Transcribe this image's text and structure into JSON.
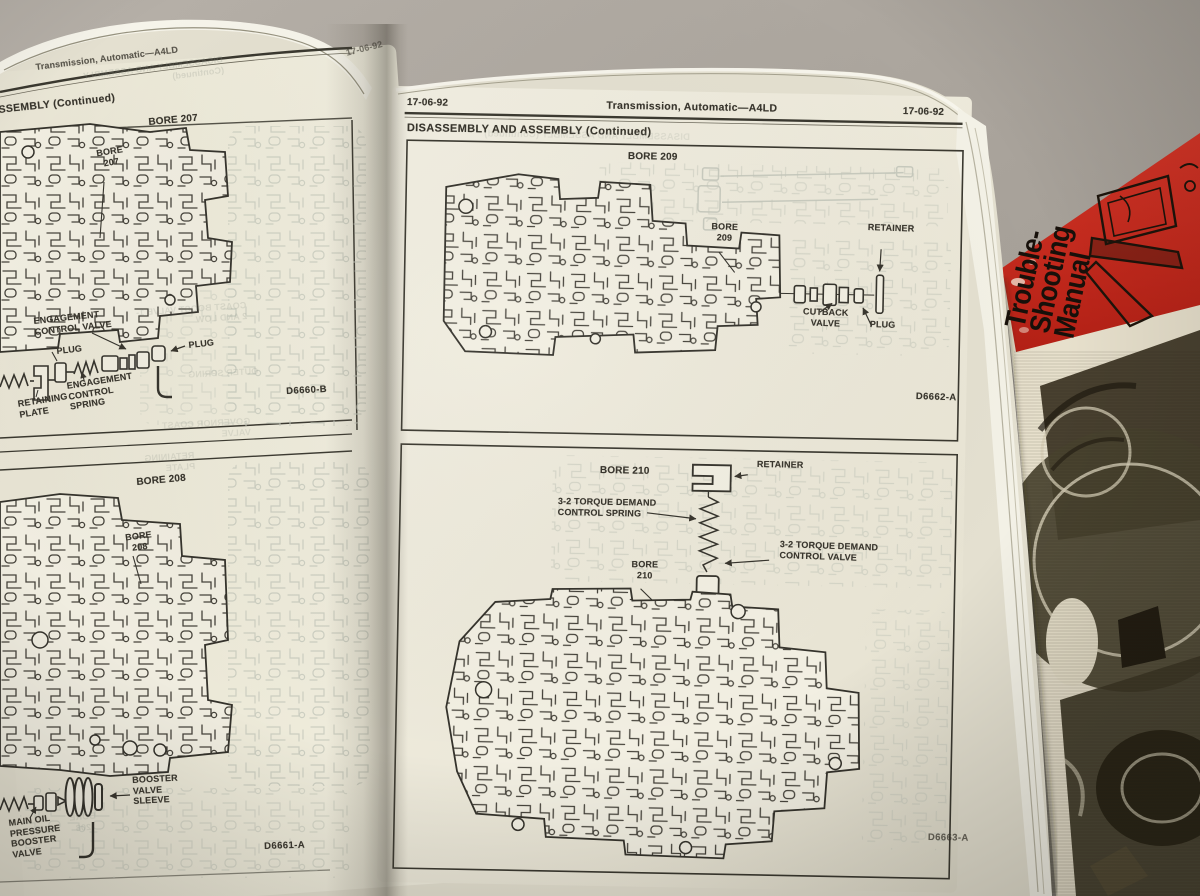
{
  "colors": {
    "desk": "#aaa49c",
    "paper": "#e9e5d6",
    "ink": "#38352d",
    "ghost_ink": "#c3c6ba",
    "red_cover": "#cc2a1d",
    "cover_ivory": "#e7e0cc"
  },
  "left_page": {
    "header_title": "Transmission, Automatic—A4LD",
    "header_page_no": "17-06-92",
    "section_title_fragment": "SSEMBLY (Continued)",
    "ghost_header": "DISASSEMBLY AND ASSEMBLY (Continued)",
    "panel_bore207": {
      "title": "BORE 207",
      "bore_callout": "BORE 207",
      "label_engagement_valve": "ENGAGEMENT CONTROL VALVE",
      "label_plug_left": "PLUG",
      "label_plug_right": "PLUG",
      "label_retaining_plate": "RETAINING PLATE",
      "label_engagement_spring": "ENGAGEMENT CONTROL SPRING",
      "figure_id": "D6660-B"
    },
    "panel_bore208": {
      "title": "BORE 208",
      "bore_callout": "BORE 208",
      "label_booster_sleeve": "BOOSTER VALVE SLEEVE",
      "label_main_oil": "MAIN OIL PRESSURE BOOSTER VALVE",
      "figure_id": "D6661-A"
    },
    "ghost_text": {
      "coast": "COAST BOOST VALVE 1-2 AND LOW",
      "outer_spring": "OUTER SPRING",
      "governor": "GOVERNOR COAST VALVE",
      "retaining_plate": "RETAINING PLATE",
      "bore": "BORE 208"
    }
  },
  "right_page": {
    "header_left": "17-06-92",
    "header_center": "Transmission, Automatic—A4LD",
    "header_right": "17-06-92",
    "section_title": "DISASSEMBLY AND ASSEMBLY (Continued)",
    "panel_bore209": {
      "title": "BORE 209",
      "bore_callout": "BORE 209",
      "label_retainer": "RETAINER",
      "label_cutback_valve": "CUTBACK VALVE",
      "label_plug": "PLUG",
      "figure_id": "D6662-A"
    },
    "panel_bore210": {
      "title": "BORE 210",
      "label_retainer": "RETAINER",
      "label_spring": "3-2 TORQUE DEMAND CONTROL SPRING",
      "label_valve": "3-2 TORQUE DEMAND CONTROL VALVE",
      "bore_callout": "BORE 210",
      "figure_id": "D6663-A"
    }
  },
  "red_book": {
    "title_line1": "Trouble-",
    "title_line2": "Shooting",
    "title_line3": "Manual"
  }
}
